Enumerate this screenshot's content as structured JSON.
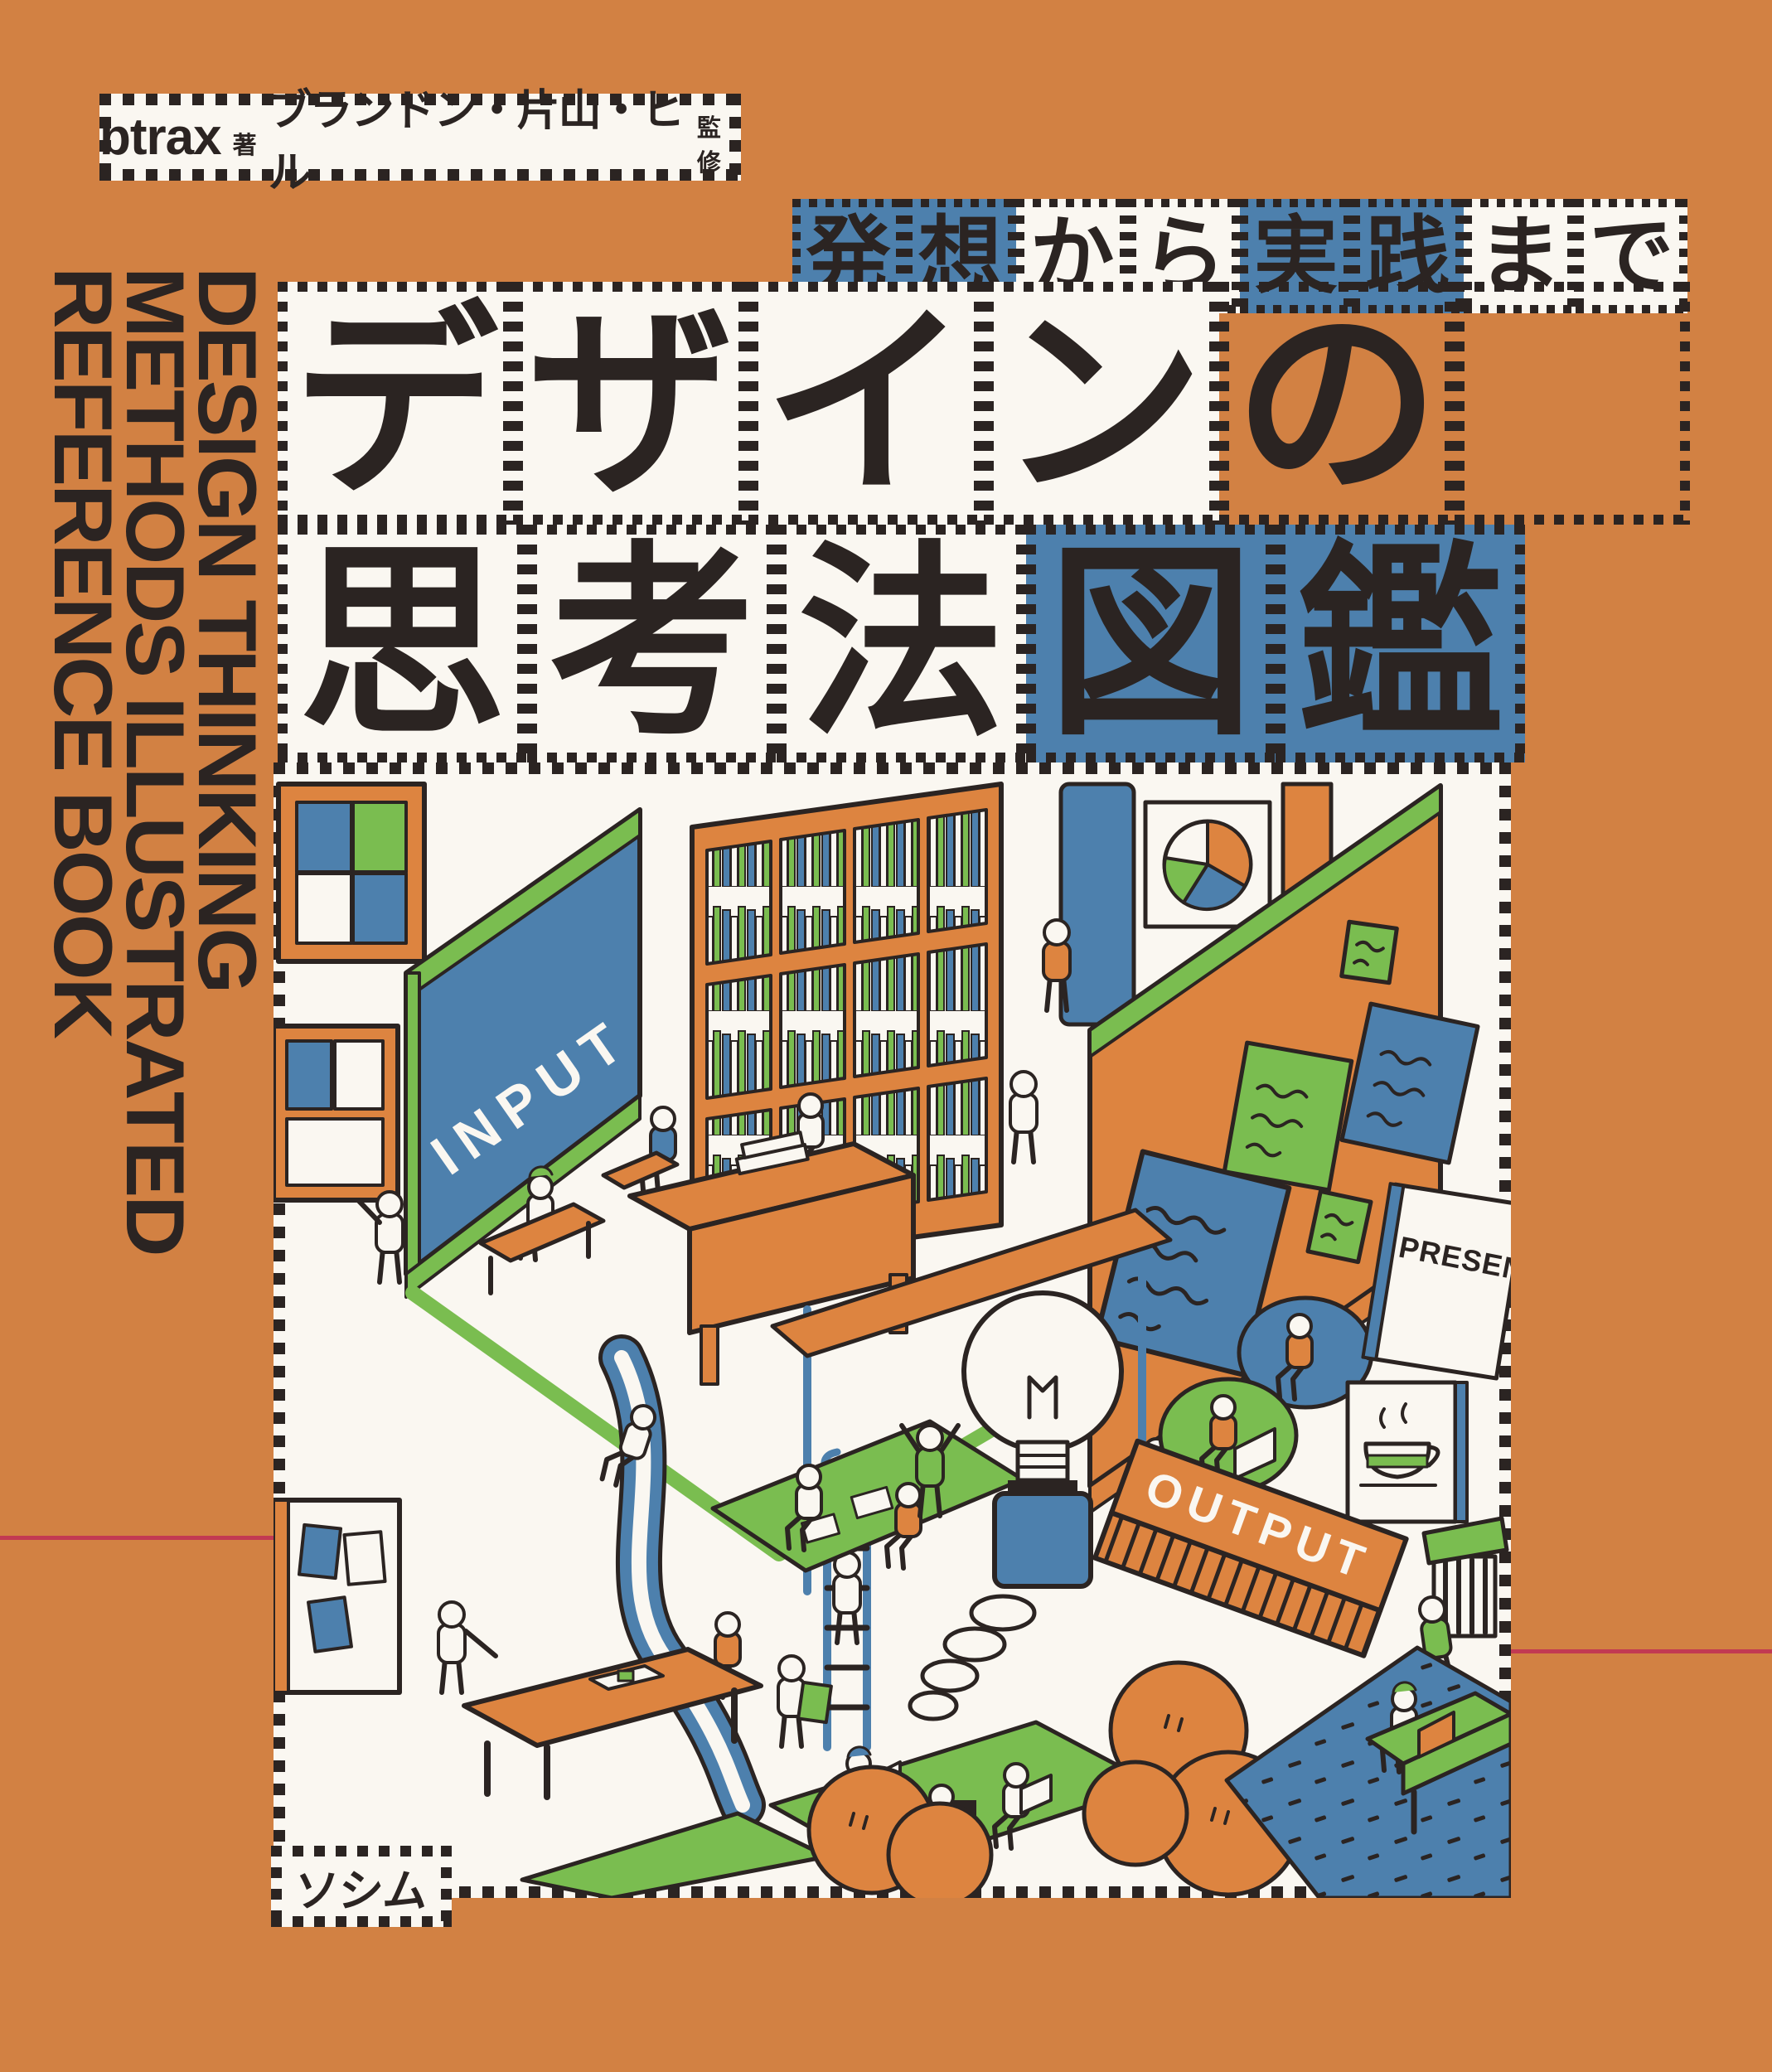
{
  "cover": {
    "author_badge": {
      "author": "btrax",
      "author_suffix": "著",
      "supervisor": "ブランドン・片山・ヒル",
      "supervisor_suffix": "監修"
    },
    "tagline_cells": [
      {
        "char": "発",
        "bg": "blue"
      },
      {
        "char": "想",
        "bg": "blue"
      },
      {
        "char": "か",
        "bg": "white"
      },
      {
        "char": "ら",
        "bg": "white"
      },
      {
        "char": "実",
        "bg": "blue"
      },
      {
        "char": "践",
        "bg": "blue"
      },
      {
        "char": "ま",
        "bg": "white"
      },
      {
        "char": "で",
        "bg": "white"
      }
    ],
    "title_row1_cells": [
      {
        "char": "デ",
        "bg": "white"
      },
      {
        "char": "ザ",
        "bg": "white"
      },
      {
        "char": "イ",
        "bg": "white"
      },
      {
        "char": "ン",
        "bg": "white"
      },
      {
        "char": "の",
        "bg": "transparent"
      },
      {
        "char": "",
        "bg": "transparent"
      }
    ],
    "title_row2_cells": [
      {
        "char": "思",
        "bg": "white"
      },
      {
        "char": "考",
        "bg": "white"
      },
      {
        "char": "法",
        "bg": "white"
      },
      {
        "char": "図",
        "bg": "blue"
      },
      {
        "char": "鑑",
        "bg": "blue"
      }
    ],
    "side_title_lines": [
      "DESIGN THINKING",
      "METHODS ILLUSTRATED",
      "REFERENCE BOOK"
    ],
    "publisher": "ソシム",
    "illustration_labels": {
      "input": "INPUT",
      "output": "OUTPUT",
      "presentation_sign": "PRESEN"
    },
    "palette": {
      "background_orange": "#D28143",
      "illustration_orange": "#DD8440",
      "blue": "#4D80AD",
      "green": "#7ABD50",
      "ink": "#2B2422",
      "paper": "#FAF7F1",
      "fold_line_red": "#C23A52"
    }
  }
}
